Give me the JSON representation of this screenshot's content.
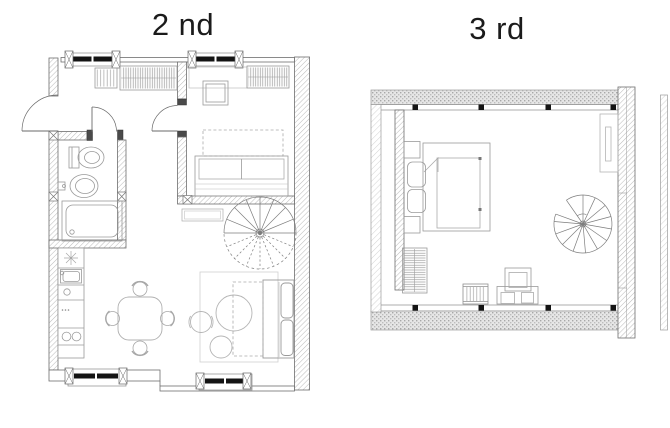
{
  "canvas": {
    "width": 670,
    "height": 428,
    "background": "#ffffff"
  },
  "floors": [
    {
      "id": "second",
      "label": "2 nd"
    },
    {
      "id": "third",
      "label": "3 rd"
    }
  ],
  "colors": {
    "title_text": "#1b1b1b",
    "wall_outline": "#6e6e6e",
    "wall_hatch": "#bcbcbc",
    "furniture_line": "#9a9a9a",
    "light_line": "#bfbfbf",
    "door_line": "#6a6a6a",
    "radiator_black": "#141414",
    "band_texture": "#b0b0b0"
  }
}
